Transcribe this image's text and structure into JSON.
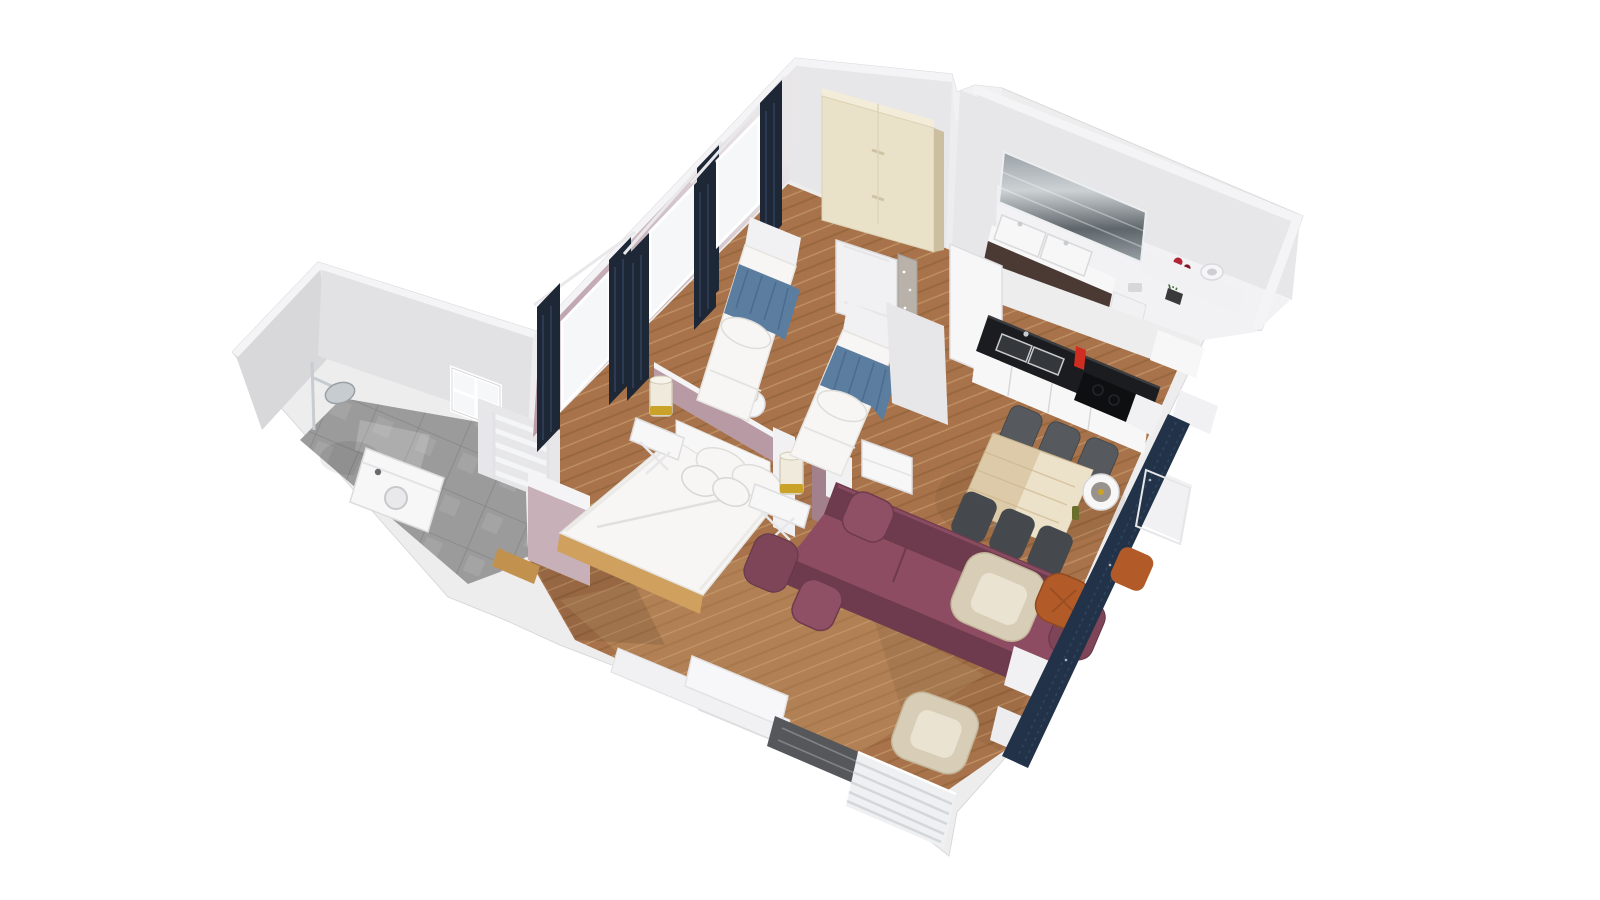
{
  "scene": {
    "type": "3d-floor-plan-render",
    "view": "axonometric dollhouse top view",
    "background": "#ffffff",
    "rooms": [
      {
        "name": "shower-room",
        "floor": "grey stone tile",
        "furniture": [
          "shower-head",
          "washing-machine",
          "towel-radiator",
          "window"
        ]
      },
      {
        "name": "bedroom",
        "walls": "dusty mauve with navy curtains",
        "floor": "herringbone parquet",
        "furniture": [
          "double-bed",
          "nightstand-left",
          "nightstand-right",
          "table-lamp x2",
          "single-bed-left",
          "single-bed-right",
          "wardrobe",
          "curtained-window x3",
          "leaning-door",
          "mirror-panel",
          "side-cabinet"
        ]
      },
      {
        "name": "living-dining",
        "floor": "herringbone parquet",
        "furniture": [
          "plum-sofa",
          "dining-table",
          "dining-chair x6",
          "pendant-lamp",
          "armchair x2",
          "orange-pouf",
          "navy-window-bench",
          "radiator",
          "marble-window-sill"
        ]
      },
      {
        "name": "kitchen",
        "furniture": [
          "tall-oven-unit",
          "black-counter",
          "double-sink",
          "red-faucet",
          "cooktop"
        ]
      },
      {
        "name": "bathroom",
        "furniture": [
          "wall-mirror",
          "double-vanity",
          "toilet",
          "rose-vase",
          "table-lamp"
        ]
      }
    ]
  },
  "palette": {
    "wallBase": "#eeedee",
    "wallFace": "#e7e6e9",
    "wallLight": "#f4f4f6",
    "wallShade": "#d8d7da",
    "annexFace": "#e2e1e4",
    "mauve": "#b79aa4",
    "mauveDark": "#a2808c",
    "mauveLight": "#c7b0b8",
    "curtain": "#1d2736",
    "curtainFold": "#32445f",
    "sheer": "#f5f7f8",
    "parquet": "#a8734a",
    "parquetDark": "#8a5c33",
    "parquetLight": "#c59a6b",
    "wood": "#cfa05e",
    "threshold": "#c2914e",
    "tile": "#9b9b9b",
    "tileDark": "#868686",
    "tileLight": "#b9b9b9",
    "white": "#f7f7f8",
    "softWhite": "#f1f1f3",
    "duvet": "#f7f6f4",
    "duvetShade": "#e2e0dc",
    "blue": "#5b7da0",
    "blueDark": "#49678a",
    "sofa": "#7e4457",
    "sofaDark": "#6e3a4d",
    "sofaSeat": "#8d4c62",
    "sofaPillow": "#8f5065",
    "tableWood": "#ddcaa8",
    "tableStreak": "#cdb68e",
    "chair": "#565a5e",
    "chairDark": "#45494d",
    "cream": "#d8cdb6",
    "creamLight": "#eae3d2",
    "pouf": "#b25b28",
    "bench": "#223349",
    "benchLine": "#31465e",
    "counter": "#1b1c1f",
    "cooktop": "#0e0f11",
    "steel": "#c7ccd0",
    "red": "#cf2d22",
    "vanity": "#4b3a33",
    "mirrorA": "#9aa1a6",
    "mirrorB": "#5f666b",
    "rose": "#b02433",
    "leaf": "#3d6b35",
    "gold": "#c9a227",
    "glass": "#efeadb",
    "radiator": "#eef0f2",
    "radiatorLine": "#d3d7da",
    "marble": "#55575a",
    "marbleVein": "#8b8d90",
    "oven": "#2b2c30"
  }
}
